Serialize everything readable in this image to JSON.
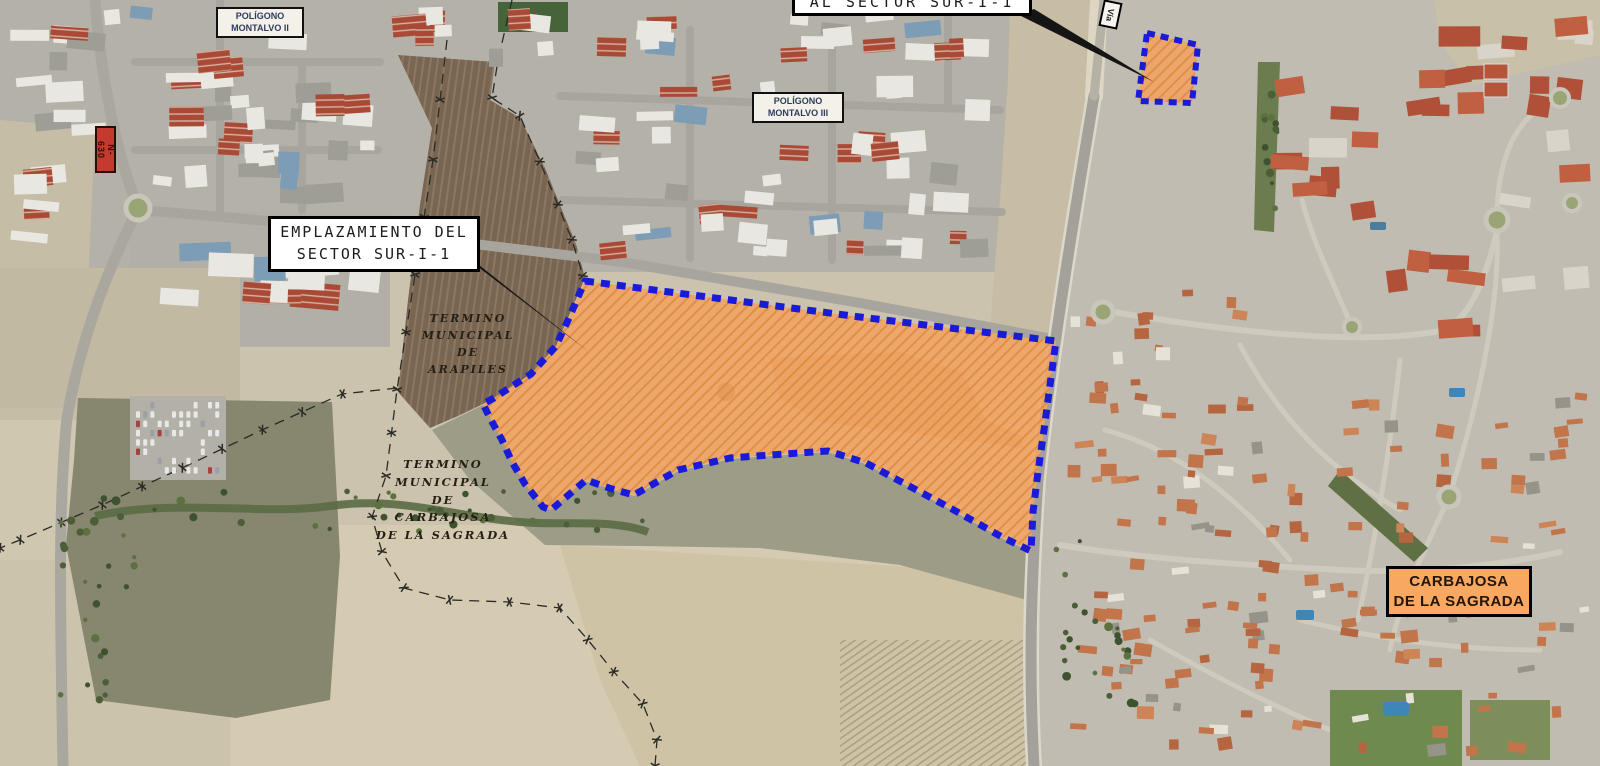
{
  "labels": {
    "al_sector": "AL SECTOR SUR-I-1",
    "poligono_montalvo_ii": "POLÍGONO\nMONTALVO II",
    "poligono_montalvo_iii": "POLÍGONO\nMONTALVO III",
    "emplazamiento": "EMPLAZAMIENTO DEL\nSECTOR SUR-I-1",
    "termino_arapiles": "TERMINO\nMUNICIPAL\nDE\nARAPILES",
    "termino_carbajosa": "TERMINO\nMUNICIPAL\nDE\nCARBAJOSA\nDE LA SAGRADA",
    "carbajosa_town": "CARBAJOSA\nDE LA SAGRADA",
    "road_n630": "N-630",
    "via": "Vía"
  },
  "colors": {
    "sector_fill": "#F2A361",
    "sector_hatch": "#D97F2E",
    "sector_border": "#1A1AD9",
    "carbajosa_label_bg": "#F8A860",
    "n630_bg": "#C23B2E",
    "annotation_box_bg": "#FFFFFF",
    "annotation_border": "#000000"
  }
}
